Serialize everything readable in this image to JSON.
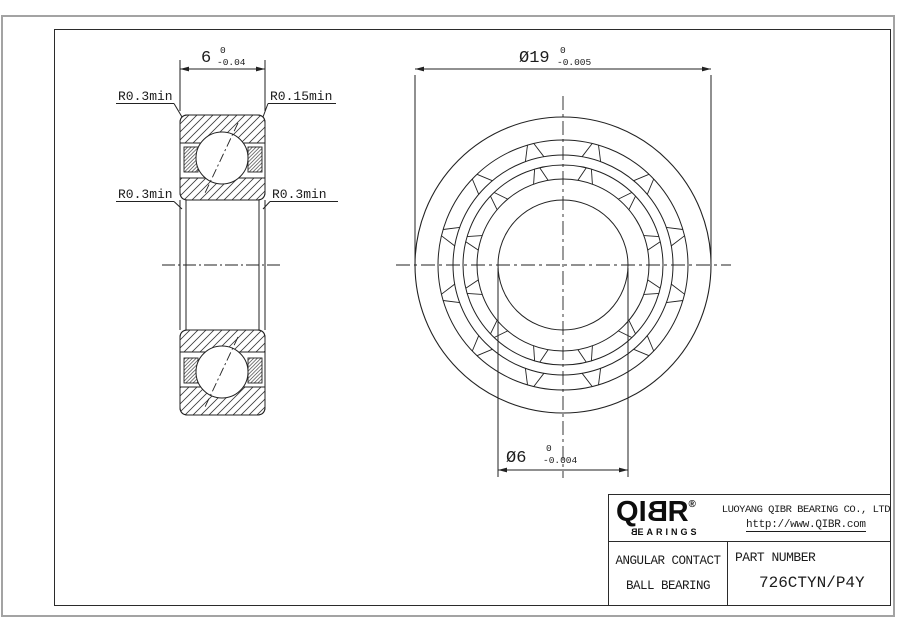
{
  "drawing": {
    "width_dim": {
      "value": "6",
      "tol_upper": "0",
      "tol_lower": "-0.04"
    },
    "od_dim": {
      "value": "Ø19",
      "tol_upper": "0",
      "tol_lower": "-0.005"
    },
    "bore_dim": {
      "value": "Ø6",
      "tol_upper": "0",
      "tol_lower": "-0.004"
    },
    "radius_labels": {
      "top_left": "R0.3min",
      "top_right": "R0.15min",
      "bottom_left": "R0.3min",
      "bottom_right": "R0.3min"
    }
  },
  "title_block": {
    "logo": {
      "l1": "Q",
      "l2": "I",
      "l3": "B",
      "l4": "R",
      "registered": "®",
      "sub_first": "B",
      "sub_rest": "EARINGS"
    },
    "company": "LUOYANG QIBR BEARING CO., LTD",
    "website": "http://www.QIBR.com",
    "product_line1": "ANGULAR CONTACT",
    "product_line2": "BALL BEARING",
    "part_number_label": "PART NUMBER",
    "part_number": "726CTYN/P4Y"
  },
  "colors": {
    "line": "#222222",
    "frame_outer": "#a3a3a3",
    "background": "#ffffff"
  }
}
